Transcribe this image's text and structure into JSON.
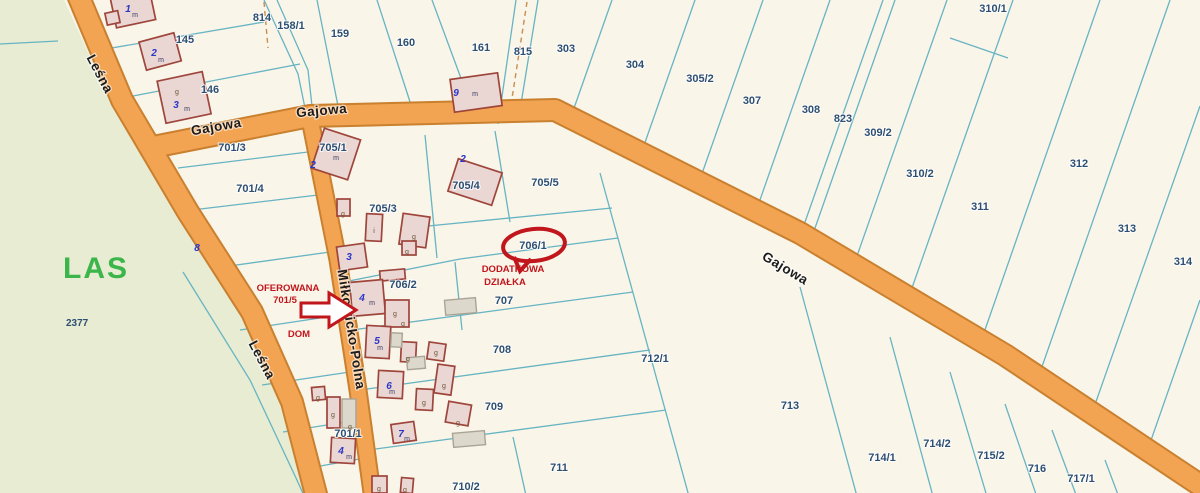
{
  "forest": {
    "label": "LAS",
    "parcel": "2377"
  },
  "streets": [
    {
      "label": "Leśna"
    },
    {
      "label": "Gajowa"
    },
    {
      "label": "Gajowa"
    },
    {
      "label": "Gajowa"
    },
    {
      "label": "Leśna"
    },
    {
      "label": "Miłkowicko-Polna"
    }
  ],
  "parcels": [
    {
      "label": "814"
    },
    {
      "label": "158/1"
    },
    {
      "label": "159"
    },
    {
      "label": "160"
    },
    {
      "label": "161"
    },
    {
      "label": "815"
    },
    {
      "label": "303"
    },
    {
      "label": "304"
    },
    {
      "label": "305/2"
    },
    {
      "label": "307"
    },
    {
      "label": "308"
    },
    {
      "label": "823"
    },
    {
      "label": "309/2"
    },
    {
      "label": "310/1"
    },
    {
      "label": "310/2"
    },
    {
      "label": "311"
    },
    {
      "label": "312"
    },
    {
      "label": "313"
    },
    {
      "label": "314"
    },
    {
      "label": "145"
    },
    {
      "label": "146"
    },
    {
      "label": "701/3"
    },
    {
      "label": "701/4"
    },
    {
      "label": "705/1"
    },
    {
      "label": "705/3"
    },
    {
      "label": "705/4"
    },
    {
      "label": "705/5"
    },
    {
      "label": "706/1"
    },
    {
      "label": "706/2"
    },
    {
      "label": "707"
    },
    {
      "label": "708"
    },
    {
      "label": "709"
    },
    {
      "label": "710/2"
    },
    {
      "label": "711"
    },
    {
      "label": "712/1"
    },
    {
      "label": "713"
    },
    {
      "label": "714/1"
    },
    {
      "label": "714/2"
    },
    {
      "label": "715/2"
    },
    {
      "label": "716"
    },
    {
      "label": "717/1"
    },
    {
      "label": "701/1"
    }
  ],
  "annotations": {
    "oferowana_line1": "OFEROWANA",
    "oferowana_line2": "701/5",
    "dom": "DOM",
    "dodatkowa_line1": "DODATKOWA",
    "dodatkowa_line2": "DZIAŁKA"
  },
  "address_numbers": [
    {
      "n": "1"
    },
    {
      "n": "2"
    },
    {
      "n": "3"
    },
    {
      "n": "9"
    },
    {
      "n": "2"
    },
    {
      "n": "2"
    },
    {
      "n": "8"
    },
    {
      "n": "3"
    },
    {
      "n": "4"
    },
    {
      "n": "5"
    },
    {
      "n": "6"
    },
    {
      "n": "7"
    },
    {
      "n": "4"
    }
  ],
  "building_marks": [
    {
      "t": "m"
    },
    {
      "t": "m"
    },
    {
      "t": "m"
    },
    {
      "t": "m"
    },
    {
      "t": "m"
    },
    {
      "t": "m"
    },
    {
      "t": "m"
    },
    {
      "t": "m"
    },
    {
      "t": "m"
    },
    {
      "t": "m"
    },
    {
      "t": "g"
    },
    {
      "t": "g"
    },
    {
      "t": "g"
    },
    {
      "t": "g"
    },
    {
      "t": "g"
    },
    {
      "t": "g"
    },
    {
      "t": "g"
    },
    {
      "t": "g"
    },
    {
      "t": "g"
    },
    {
      "t": "g"
    },
    {
      "t": "g"
    },
    {
      "t": "g"
    },
    {
      "t": "g"
    },
    {
      "t": "g"
    },
    {
      "t": "g"
    },
    {
      "t": "g"
    },
    {
      "t": "i"
    }
  ],
  "colors": {
    "parcel_bg": "#faf5e9",
    "forest": "#e7ecd2",
    "road_fill": "#f2a452",
    "road_edge": "#c9802f",
    "parcel_line": "#67b4c3",
    "parcel_label": "#2d4f72",
    "building_outline": "#9e453c",
    "building_fill": "#ead6d2",
    "building_gray_fill": "#ddd8cc",
    "building_gray_outline": "#a9a496",
    "address_blue": "#2a36c8",
    "mark_g": "#6b5233",
    "annotation_red": "#c0161c",
    "forest_label_green": "#3cb54a",
    "road_label": "#1c1c1c",
    "dashed_path": "#c98d4e"
  }
}
